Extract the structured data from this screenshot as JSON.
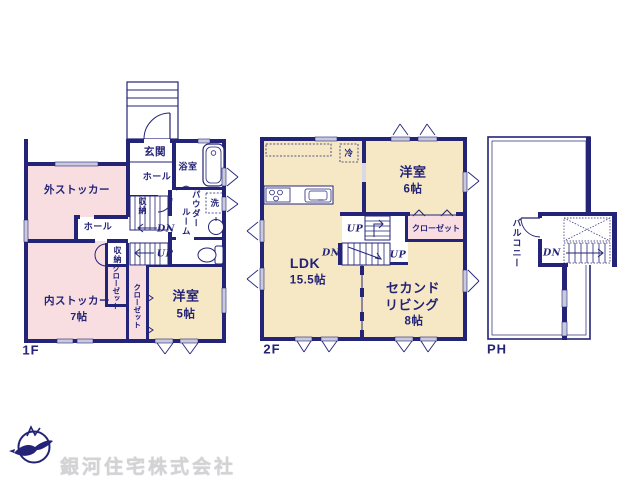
{
  "floors": {
    "f1": {
      "label": "1F",
      "genkan": "玄関",
      "hall_upper": "ホール",
      "hall_mid": "ホール",
      "bath": "浴室",
      "powder_line1": "パウダー",
      "powder_line2": "ルーム",
      "laundry": "洗",
      "storage_upper": "収納",
      "storage_lower": "収納",
      "closet_a": "クローゼット",
      "closet_b": "クローゼット",
      "soto_stocker": "外ストッカー",
      "uchi_stocker": "内ストッカー",
      "uchi_stocker_size": "7帖",
      "yoshitsu": "洋室",
      "yoshitsu_size": "5帖",
      "dn": "DN",
      "up": "UP"
    },
    "f2": {
      "label": "2F",
      "ldk": "LDK",
      "ldk_size": "15.5帖",
      "fridge": "冷",
      "yoshitsu": "洋室",
      "yoshitsu_size": "6帖",
      "closet": "クローゼット",
      "second_living_line1": "セカンド",
      "second_living_line2": "リビング",
      "second_living_size": "8帖",
      "up1": "UP",
      "dn": "DN",
      "up2": "UP"
    },
    "ph": {
      "label": "PH",
      "balcony": "バルコニー",
      "dn": "DN"
    }
  },
  "company": {
    "name": "銀河住宅株式会社"
  },
  "colors": {
    "wall": "#232377",
    "room_pink": "#f8dee1",
    "room_yellow": "#f6e8c4",
    "window": "#c9cade",
    "doorway": "#d8d8ea",
    "logo_text": "#d3d3d6"
  }
}
